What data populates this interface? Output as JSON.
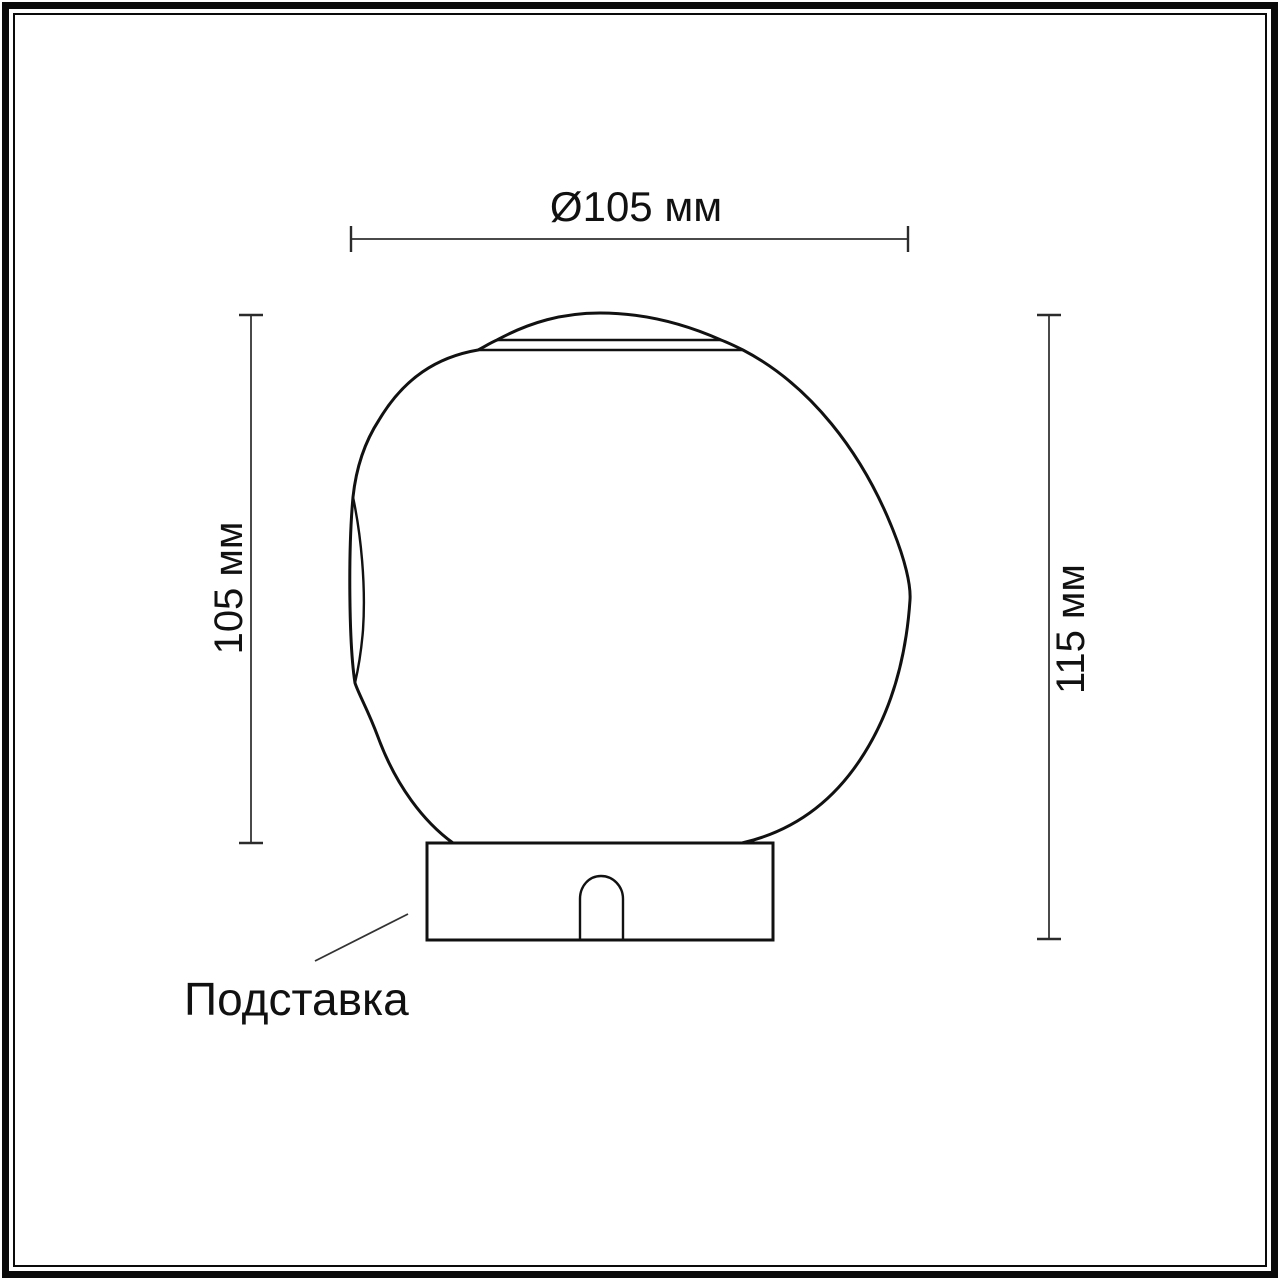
{
  "diagram": {
    "type": "technical-dimension-drawing",
    "subject": "table-lamp-with-blob-glass-shade-on-cylindrical-base",
    "dimension_labels": {
      "diameter": "Ø105 мм",
      "shade_height": "105 мм",
      "total_height": "115 мм"
    },
    "callouts": {
      "base": "Подставка"
    },
    "colors": {
      "background": "#ffffff",
      "frame": "#0a0a0a",
      "outline": "#111111",
      "dimension_line": "#4a4a4a",
      "tick": "#2b2b2b",
      "leader": "#333333"
    }
  }
}
